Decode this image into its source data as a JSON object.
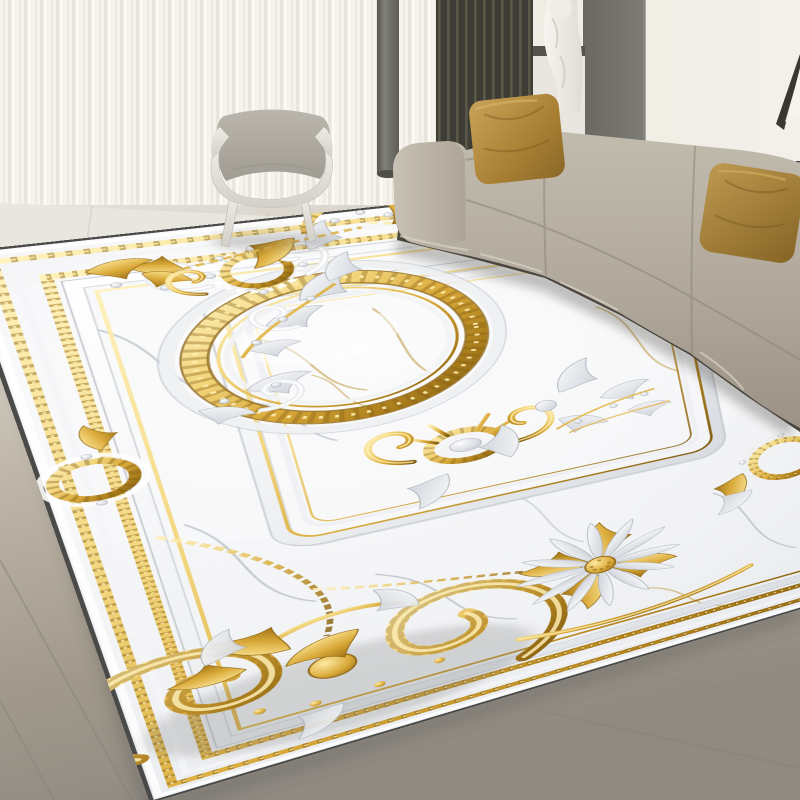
{
  "meta": {
    "type": "product-photograph",
    "subject": "Ornate gold and white marble baroque area rug staged in a modern living room"
  },
  "palette": {
    "wall": "#efece4",
    "wall_right": "#f3f0e9",
    "curtain": "#f7f5ef",
    "curtain_shadow": "#d8d4c9",
    "pole": "#6e6d67",
    "slat_dark": "#3e3d35",
    "slat_light": "#5a5849",
    "panel_gray": "#75746c",
    "sculpture_white": "#f2f0ea",
    "frame_dark": "#3a372f",
    "floor_light": "#e7e4dc",
    "floor_tan": "#b3ab9d",
    "floor_gray": "#948f87",
    "grout": "#8a8478",
    "sofa_taupe": "#b4ada0",
    "sofa_base": "#4a463e",
    "pillow_gold": "#b3914b",
    "chair_fabric": "#b2aea5",
    "chair_shell": "#e5e2da",
    "rug_marble": "#f5f5f6",
    "rug_edge": "#3f3f3d",
    "vein_gray": "#99a1ab",
    "vein_gold": "#b8922f",
    "gold_light": "#ffeeae",
    "gold_mid": "#d9a62f",
    "gold_dark": "#7a5406",
    "molding_white": "#ffffff",
    "molding_shadow": "#c2c7cd",
    "shadow": "#55544e"
  },
  "scene": {
    "objects": [
      {
        "name": "sheer-curtains"
      },
      {
        "name": "dark-pole"
      },
      {
        "name": "slat-accent-wall"
      },
      {
        "name": "sculpture-bust-on-pedestal"
      },
      {
        "name": "gray-wall-panel"
      },
      {
        "name": "picture-frame-corner"
      },
      {
        "name": "three-seat-sofa"
      },
      {
        "name": "velvet-pillow-left"
      },
      {
        "name": "velvet-pillow-right"
      },
      {
        "name": "lounge-chair"
      },
      {
        "name": "tile-floor"
      },
      {
        "name": "baroque-area-rug"
      }
    ]
  },
  "rug": {
    "motifs": [
      "dark-outer-edge",
      "gold-chain-border",
      "gold-bead-double-border",
      "white-molding-band",
      "inner-panel-frame-with-gold-piping",
      "central-gold-rope-ring",
      "marble-field-with-gray-and-gold-veins",
      "top-left-gold-ring-ornament",
      "top-edge-gold-medallion",
      "white-acanthus-scrolls",
      "gold-shell-cartouche",
      "left-edge-medallion",
      "right-edge-gold-medallion",
      "large-gold-corner-scrolls",
      "white-daisy-with-gold-center",
      "gold-garland-chains"
    ]
  }
}
